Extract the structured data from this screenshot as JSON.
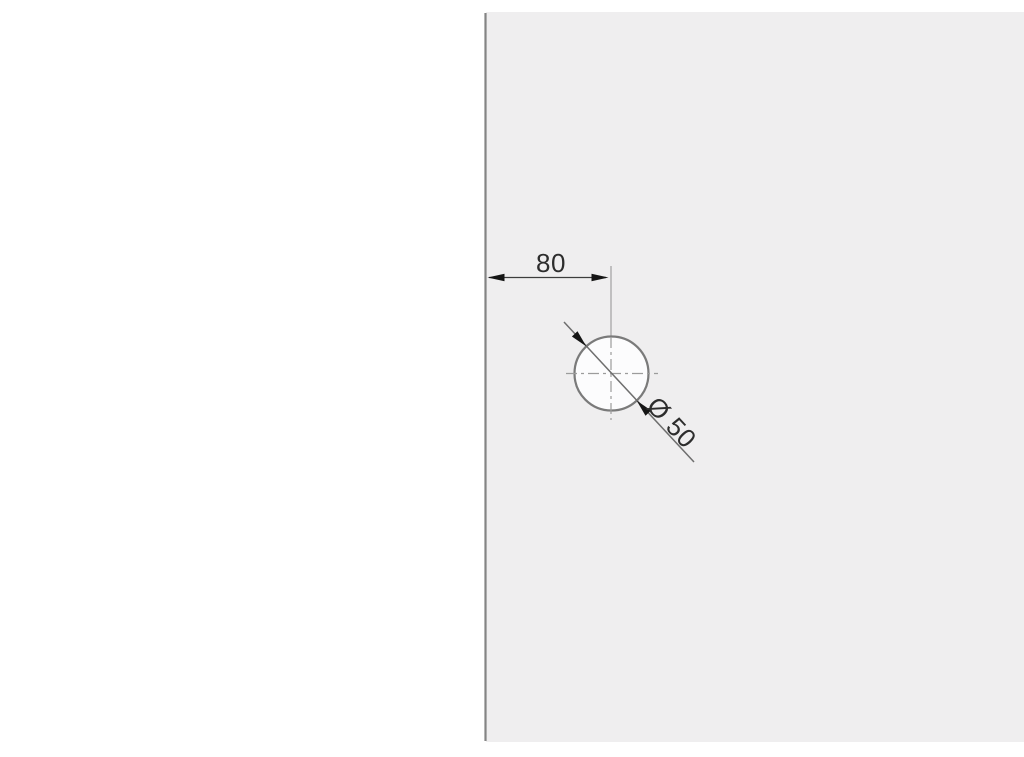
{
  "drawing": {
    "type": "technical-dimension-drawing",
    "dimensions": {
      "width": {
        "value": "80"
      },
      "diameter": {
        "value": "Ø 50"
      }
    },
    "colors": {
      "canvas_bg": "#ffffff",
      "panel_bg": "#efeeef",
      "panel_edge": "#848484",
      "dimension_line": "#3d3d3d",
      "arrow_fill": "#151515",
      "extension_line": "#a6a6a6",
      "centerline": "#9c9c9c",
      "circle_stroke": "#7a7a7a",
      "circle_fill": "#fcfcfd",
      "leader_line": "#6e6e6e",
      "label_text": "#2d2d2d"
    }
  }
}
